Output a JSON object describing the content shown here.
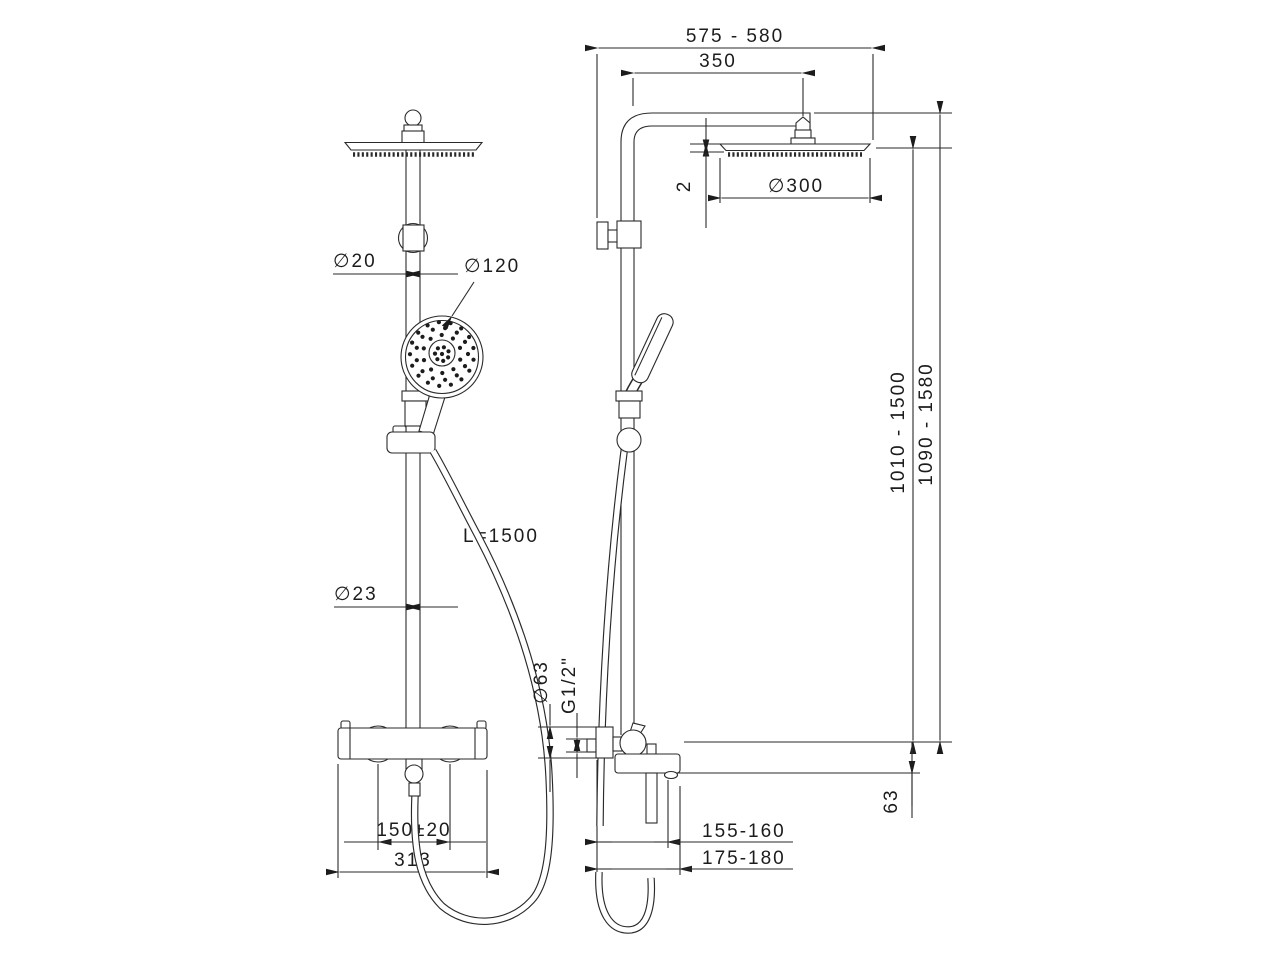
{
  "colors": {
    "line": "#1c1c1c",
    "background": "#ffffff"
  },
  "front_view": {
    "dims": {
      "riser_diameter": "∅20",
      "hand_shower_diameter": "∅120",
      "hose_length": "L=1500",
      "lower_riser_diameter": "∅23",
      "handle_centers": "150±20",
      "mixer_width": "313"
    }
  },
  "side_view": {
    "dims": {
      "total_reach": "575 - 580",
      "arm_reach": "350",
      "head_diameter": "∅300",
      "head_thickness": "2",
      "riser_height_range": "1010 - 1500",
      "total_height_range": "1090 - 1580",
      "escutcheon_diameter": "∅63",
      "thread_size": "G1/2\"",
      "spout_offset": "63",
      "spout_reach": "155-160",
      "hose_connection_reach": "175-180"
    }
  }
}
